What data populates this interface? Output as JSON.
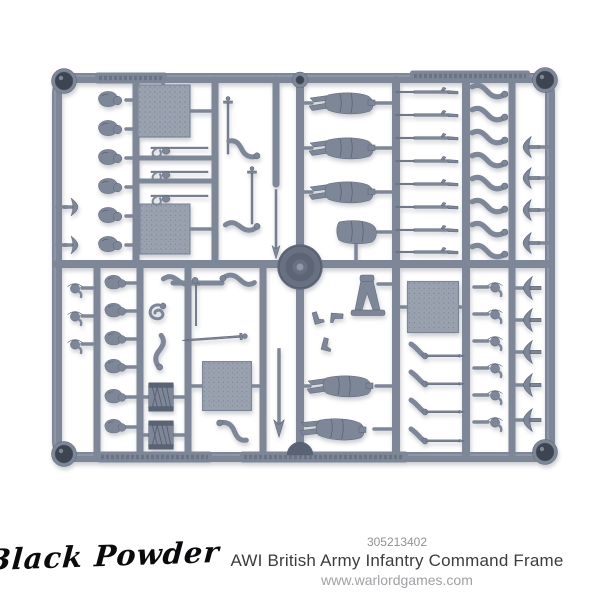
{
  "colors": {
    "bg": "#ffffff",
    "plastic": "#7e8798",
    "plastic-light": "#9aa2b0",
    "plastic-dark": "#5a6374",
    "plastic-deep": "#3d4452",
    "base-circle": "#687181",
    "text-dark": "#3c3c3e",
    "text-grey": "#909195",
    "text-light": "#9fa1a4",
    "logo-color": "#0b0b0d"
  },
  "footer": {
    "logo": "Black Powder",
    "code": "305213402",
    "title": "AWI British Army Infantry Command Frame",
    "website": "www.warlordgames.com"
  },
  "image": {
    "description": "Grey plastic model sprue with miniature soldier parts: bodies, heads, bearskins, tricorn hats, muskets, arms, swords, drums and bases",
    "sprue": {
      "runners": [
        [
          136,
          80,
          136,
          264,
          7
        ],
        [
          215,
          80,
          215,
          264,
          7
        ],
        [
          276,
          80,
          276,
          184,
          7
        ],
        [
          300,
          80,
          300,
          455,
          8
        ],
        [
          396,
          80,
          396,
          455,
          8
        ],
        [
          466,
          80,
          466,
          455,
          8
        ],
        [
          512,
          80,
          512,
          455,
          7
        ],
        [
          97,
          264,
          97,
          455,
          7
        ],
        [
          140,
          264,
          140,
          455,
          7
        ],
        [
          188,
          264,
          188,
          455,
          7
        ],
        [
          263,
          264,
          263,
          455,
          7
        ],
        [
          57,
          264,
          550,
          264,
          8
        ],
        [
          136,
          158,
          215,
          158,
          5
        ],
        [
          136,
          181,
          215,
          181,
          5
        ],
        [
          173,
          283,
          222,
          283,
          5
        ]
      ],
      "stems": [
        [
          126,
          100,
          137,
          100
        ],
        [
          126,
          129,
          137,
          129
        ],
        [
          126,
          158,
          137,
          158
        ],
        [
          126,
          187,
          137,
          187
        ],
        [
          126,
          216,
          137,
          216
        ],
        [
          126,
          245,
          137,
          245
        ],
        [
          57,
          207,
          67,
          207
        ],
        [
          57,
          245,
          67,
          245
        ],
        [
          136,
          111,
          141,
          111
        ],
        [
          187,
          111,
          215,
          111
        ],
        [
          163,
          80,
          163,
          88
        ],
        [
          136,
          229,
          143,
          229
        ],
        [
          187,
          229,
          215,
          229
        ],
        [
          300,
          103,
          312,
          103
        ],
        [
          376,
          103,
          396,
          103
        ],
        [
          300,
          148,
          312,
          148
        ],
        [
          376,
          148,
          396,
          148
        ],
        [
          300,
          192,
          312,
          192
        ],
        [
          376,
          192,
          396,
          192
        ],
        [
          378,
          232,
          396,
          232
        ],
        [
          356,
          243,
          356,
          264
        ],
        [
          538,
          147,
          550,
          147
        ],
        [
          538,
          178,
          550,
          178
        ],
        [
          538,
          210,
          550,
          210
        ],
        [
          538,
          243,
          550,
          243
        ],
        [
          82,
          288,
          97,
          288
        ],
        [
          82,
          316,
          97,
          316
        ],
        [
          82,
          344,
          97,
          344
        ],
        [
          125,
          283,
          140,
          283
        ],
        [
          125,
          311,
          140,
          311
        ],
        [
          125,
          339,
          140,
          339
        ],
        [
          125,
          367,
          140,
          367
        ],
        [
          125,
          397,
          140,
          397
        ],
        [
          125,
          427,
          140,
          427
        ],
        [
          140,
          397,
          149,
          397
        ],
        [
          173,
          397,
          188,
          397
        ],
        [
          140,
          435,
          149,
          435
        ],
        [
          173,
          435,
          188,
          435
        ],
        [
          188,
          386,
          204,
          386
        ],
        [
          250,
          386,
          263,
          386
        ],
        [
          396,
          307,
          409,
          307
        ],
        [
          457,
          307,
          466,
          307
        ],
        [
          378,
          284,
          396,
          284
        ],
        [
          300,
          386,
          310,
          386
        ],
        [
          376,
          386,
          396,
          386
        ],
        [
          374,
          429,
          396,
          429
        ],
        [
          474,
          287,
          488,
          287
        ],
        [
          474,
          314,
          488,
          314
        ],
        [
          474,
          341,
          488,
          341
        ],
        [
          474,
          368,
          488,
          368
        ],
        [
          474,
          395,
          488,
          395
        ],
        [
          474,
          422,
          488,
          422
        ],
        [
          512,
          288,
          524,
          288
        ],
        [
          512,
          320,
          524,
          320
        ],
        [
          512,
          352,
          524,
          352
        ],
        [
          512,
          385,
          524,
          385
        ],
        [
          512,
          420,
          524,
          420
        ]
      ],
      "labels": [
        [
          95,
          78,
          72
        ],
        [
          410,
          76,
          120
        ],
        [
          97,
          457,
          115
        ],
        [
          240,
          457,
          168
        ]
      ],
      "parts": [
        {
          "t": "eyelet",
          "x": 64,
          "y": 81
        },
        {
          "t": "eyelet",
          "x": 545,
          "y": 80
        },
        {
          "t": "eyelet",
          "x": 64,
          "y": 454
        },
        {
          "t": "eyelet",
          "x": 545,
          "y": 452
        },
        {
          "t": "ring",
          "x": 300,
          "y": 80
        },
        {
          "t": "dome",
          "x": 300,
          "y": 452
        },
        {
          "t": "circle-base",
          "x": 300,
          "y": 267
        },
        {
          "t": "square",
          "x": 164,
          "y": 111
        },
        {
          "t": "square",
          "x": 165,
          "y": 229,
          "s": 0.96
        },
        {
          "t": "square",
          "x": 227,
          "y": 386,
          "s": 0.94
        },
        {
          "t": "square",
          "x": 433,
          "y": 307,
          "s": 0.98
        },
        {
          "t": "head-bearskin",
          "x": 112,
          "y": 100
        },
        {
          "t": "head-bearskin",
          "x": 112,
          "y": 129
        },
        {
          "t": "head-bearskin",
          "x": 112,
          "y": 158
        },
        {
          "t": "head-bearskin",
          "x": 112,
          "y": 187
        },
        {
          "t": "head-bearskin",
          "x": 112,
          "y": 216
        },
        {
          "t": "head-bearskin",
          "x": 112,
          "y": 245
        },
        {
          "t": "hat",
          "x": 72,
          "y": 207,
          "r": 90
        },
        {
          "t": "hat",
          "x": 72,
          "y": 245,
          "r": 90
        },
        {
          "t": "sabre",
          "x": 168,
          "y": 148
        },
        {
          "t": "sabre",
          "x": 168,
          "y": 172
        },
        {
          "t": "sabre",
          "x": 168,
          "y": 196
        },
        {
          "t": "sword-v",
          "x": 228,
          "y": 128
        },
        {
          "t": "sword-v",
          "x": 252,
          "y": 198
        },
        {
          "t": "sword-v",
          "x": 196,
          "y": 305,
          "s": 0.8
        },
        {
          "t": "arm",
          "x": 243,
          "y": 150,
          "r": 15
        },
        {
          "t": "arm",
          "x": 242,
          "y": 227,
          "r": -10
        },
        {
          "t": "spear",
          "x": 276,
          "y": 222,
          "s": 0.9
        },
        {
          "t": "spear",
          "x": 279,
          "y": 390,
          "s": 1.15
        },
        {
          "t": "body",
          "x": 348,
          "y": 103
        },
        {
          "t": "body",
          "x": 348,
          "y": 148
        },
        {
          "t": "body",
          "x": 348,
          "y": 192
        },
        {
          "t": "torso",
          "x": 357,
          "y": 232
        },
        {
          "t": "musket",
          "x": 428,
          "y": 92
        },
        {
          "t": "musket",
          "x": 428,
          "y": 115
        },
        {
          "t": "musket",
          "x": 428,
          "y": 138
        },
        {
          "t": "musket",
          "x": 428,
          "y": 161
        },
        {
          "t": "musket",
          "x": 428,
          "y": 184
        },
        {
          "t": "musket",
          "x": 428,
          "y": 207
        },
        {
          "t": "musket",
          "x": 428,
          "y": 230
        },
        {
          "t": "musket",
          "x": 428,
          "y": 252
        },
        {
          "t": "arm",
          "x": 489,
          "y": 92,
          "s": 1.05
        },
        {
          "t": "arm",
          "x": 489,
          "y": 115,
          "s": 1.05
        },
        {
          "t": "arm",
          "x": 489,
          "y": 138,
          "s": 1.05
        },
        {
          "t": "arm",
          "x": 489,
          "y": 161,
          "s": 1.05
        },
        {
          "t": "arm",
          "x": 489,
          "y": 184,
          "s": 1.05
        },
        {
          "t": "arm",
          "x": 489,
          "y": 207,
          "s": 1.05
        },
        {
          "t": "arm",
          "x": 489,
          "y": 230,
          "s": 1.05
        },
        {
          "t": "arm",
          "x": 489,
          "y": 252,
          "s": 1.05
        },
        {
          "t": "hat",
          "x": 530,
          "y": 147,
          "r": -90,
          "s": 1.15
        },
        {
          "t": "hat",
          "x": 530,
          "y": 178,
          "r": -90,
          "s": 1.15
        },
        {
          "t": "hat",
          "x": 530,
          "y": 210,
          "r": -90,
          "s": 1.15
        },
        {
          "t": "hat",
          "x": 530,
          "y": 243,
          "r": -90,
          "s": 1.15
        },
        {
          "t": "head-tricorn",
          "x": 75,
          "y": 288
        },
        {
          "t": "head-tricorn",
          "x": 75,
          "y": 316
        },
        {
          "t": "head-tricorn",
          "x": 75,
          "y": 344
        },
        {
          "t": "head-bearskin",
          "x": 117,
          "y": 283,
          "s": 0.9
        },
        {
          "t": "head-bearskin",
          "x": 117,
          "y": 311,
          "s": 0.9
        },
        {
          "t": "head-bearskin",
          "x": 117,
          "y": 339,
          "s": 0.9
        },
        {
          "t": "head-bearskin",
          "x": 117,
          "y": 367,
          "s": 0.9
        },
        {
          "t": "head-bearskin",
          "x": 117,
          "y": 397,
          "s": 0.9
        },
        {
          "t": "head-bearskin",
          "x": 117,
          "y": 427,
          "s": 0.9
        },
        {
          "t": "curly",
          "x": 157,
          "y": 313
        },
        {
          "t": "arm",
          "x": 180,
          "y": 281,
          "r": -10
        },
        {
          "t": "arm",
          "x": 238,
          "y": 279,
          "r": 175
        },
        {
          "t": "arm",
          "x": 159,
          "y": 352,
          "r": 80
        },
        {
          "t": "arm",
          "x": 233,
          "y": 430,
          "r": -160
        },
        {
          "t": "sword-h",
          "x": 218,
          "y": 338,
          "r": -4
        },
        {
          "t": "drum",
          "x": 161,
          "y": 397,
          "s": 0.95
        },
        {
          "t": "drum",
          "x": 161,
          "y": 435,
          "s": 0.95
        },
        {
          "t": "boot",
          "x": 316,
          "y": 318,
          "r": -15
        },
        {
          "t": "boot",
          "x": 325,
          "y": 344,
          "r": 15
        },
        {
          "t": "boot",
          "x": 337,
          "y": 316,
          "r": 95
        },
        {
          "t": "legs",
          "x": 368,
          "y": 306
        },
        {
          "t": "arm-sword",
          "x": 425,
          "y": 352
        },
        {
          "t": "arm-sword",
          "x": 425,
          "y": 380
        },
        {
          "t": "arm-sword",
          "x": 425,
          "y": 408
        },
        {
          "t": "arm-sword",
          "x": 425,
          "y": 437
        },
        {
          "t": "body",
          "x": 346,
          "y": 386
        },
        {
          "t": "body",
          "x": 339,
          "y": 429,
          "r": 2
        },
        {
          "t": "head-tricorn",
          "x": 495,
          "y": 287
        },
        {
          "t": "head-tricorn",
          "x": 495,
          "y": 314
        },
        {
          "t": "head-tricorn",
          "x": 495,
          "y": 341
        },
        {
          "t": "head-tricorn",
          "x": 495,
          "y": 368
        },
        {
          "t": "head-tricorn",
          "x": 495,
          "y": 395
        },
        {
          "t": "head-tricorn",
          "x": 495,
          "y": 422
        },
        {
          "t": "hat",
          "x": 531,
          "y": 288,
          "r": -90,
          "s": 1.25
        },
        {
          "t": "hat",
          "x": 531,
          "y": 320,
          "r": -90,
          "s": 1.25
        },
        {
          "t": "hat",
          "x": 531,
          "y": 352,
          "r": -90,
          "s": 1.25
        },
        {
          "t": "hat",
          "x": 531,
          "y": 385,
          "r": -90,
          "s": 1.25
        },
        {
          "t": "hat",
          "x": 531,
          "y": 420,
          "r": -90,
          "s": 1.25
        }
      ]
    }
  }
}
